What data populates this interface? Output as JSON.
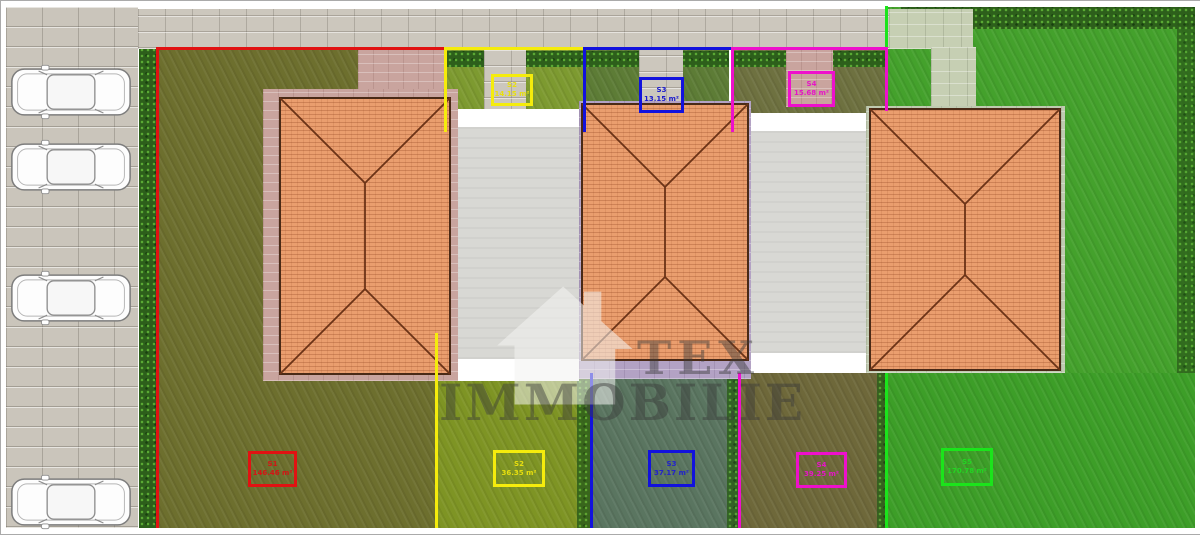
{
  "watermark": {
    "line1": "TEX",
    "line2": "IMMOBILIE"
  },
  "boundaries": {
    "s1_color": "#e11212",
    "s2_color": "#f5ec0c",
    "s3_color": "#1212dd",
    "s4_color": "#ee10cc",
    "s5_color": "#1be41b"
  },
  "labels": {
    "s1_bottom": {
      "id": "S1",
      "area": "146.46 m²"
    },
    "s2_top": {
      "id": "S2",
      "area": "14.15 m²"
    },
    "s2_bottom": {
      "id": "S2",
      "area": "36.35 m²"
    },
    "s3_top": {
      "id": "S3",
      "area": "13.15 m²"
    },
    "s3_bottom": {
      "id": "S3",
      "area": "37.17 m²"
    },
    "s4_top": {
      "id": "S4",
      "area": "15.68 m²"
    },
    "s4_bottom": {
      "id": "S4",
      "area": "39.25 m²"
    },
    "s5_bottom": {
      "id": "S5",
      "area": "170.78 m²"
    }
  }
}
